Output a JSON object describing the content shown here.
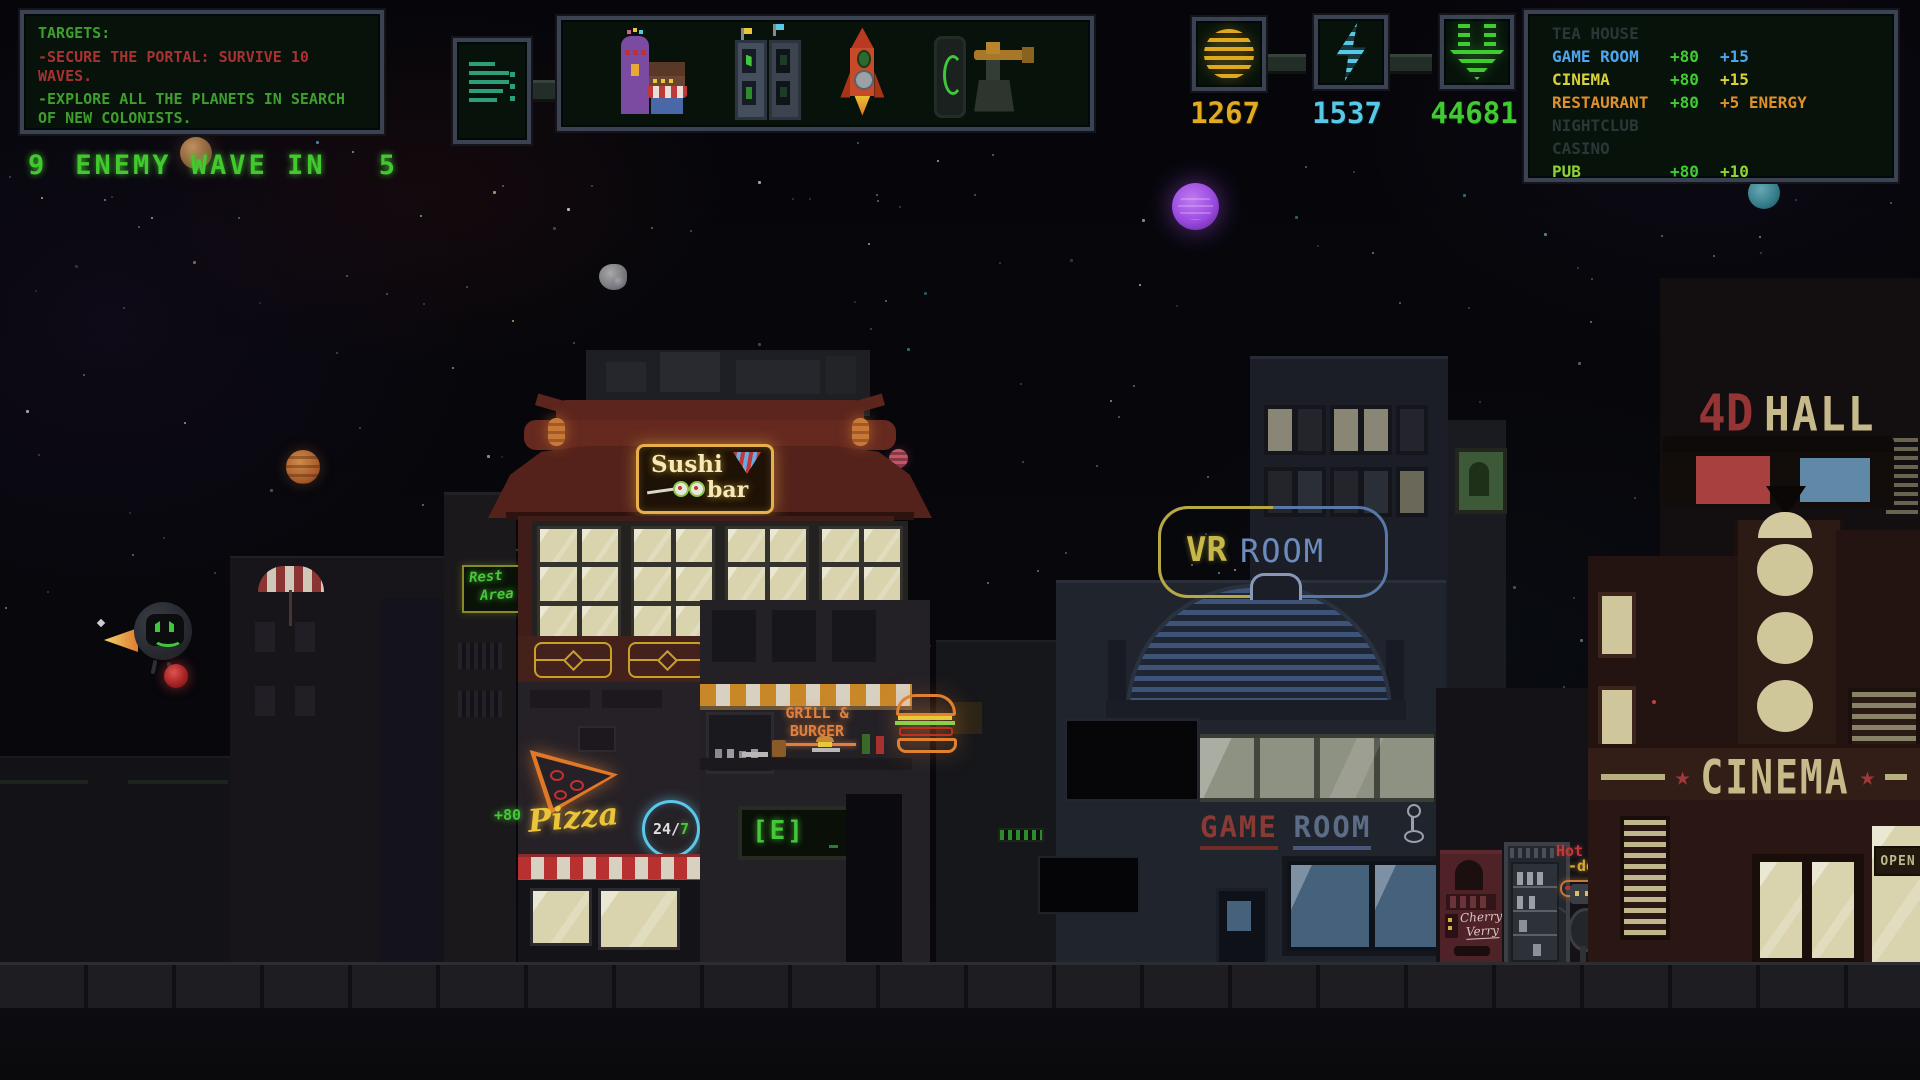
{
  "hud": {
    "targets": {
      "title": "TARGETS:",
      "objective1": "-SECURE THE PORTAL: SURVIVE 10 WAVES.",
      "objective2": "-EXPLORE ALL THE PLANETS IN SEARCH OF NEW COLONISTS.",
      "objective1_color": "#a83232",
      "objective2_color": "#3f9e2d"
    },
    "wave": {
      "count": "9",
      "label": "ENEMY WAVE IN",
      "timer": "5"
    },
    "resources": [
      {
        "id": "coins",
        "value": "1267",
        "color": "#e2aa1e",
        "icon": "coin-icon"
      },
      {
        "id": "energy",
        "value": "1537",
        "color": "#58c8e8",
        "icon": "lightning-icon"
      },
      {
        "id": "income",
        "value": "44681",
        "color": "#40cb32",
        "icon": "download-arrows-icon"
      }
    ],
    "toolbar_icons": [
      "menu-lines-icon",
      "shop-buildings-icon",
      "machines-icon",
      "rocket-icon",
      "phone-turret-icon"
    ],
    "build_menu": {
      "cost_color": "#40cb32",
      "rows": [
        {
          "label": "TEA HOUSE",
          "cost": "",
          "bonus": "",
          "color": "#2b3737",
          "enabled": false
        },
        {
          "label": "GAME ROOM",
          "cost": "+80",
          "bonus": "+15",
          "color": "#4da6f0",
          "enabled": true
        },
        {
          "label": "CINEMA",
          "cost": "+80",
          "bonus": "+15",
          "color": "#d8d23a",
          "enabled": true
        },
        {
          "label": "RESTAURANT",
          "cost": "+80",
          "bonus": "+5 ENERGY",
          "color": "#e0902a",
          "enabled": true
        },
        {
          "label": "NIGHTCLUB",
          "cost": "",
          "bonus": "",
          "color": "#2b3737",
          "enabled": false
        },
        {
          "label": "CASINO",
          "cost": "",
          "bonus": "",
          "color": "#2b3737",
          "enabled": false
        },
        {
          "label": "PUB",
          "cost": "+80",
          "bonus": "+10",
          "color": "#8fd435",
          "enabled": true
        }
      ]
    }
  },
  "scene": {
    "sushi_bar": {
      "line1": "Sushi",
      "line2": "bar"
    },
    "rest_area": {
      "line1": "Rest",
      "line2": "Area"
    },
    "pizza": {
      "name": "Pizza",
      "bonus": "+80",
      "badge_left": "24/",
      "badge_right": "7"
    },
    "grill": {
      "line1": "GRILL &",
      "line2": "BURGER"
    },
    "interact_prompt": "[E]",
    "vr_room": {
      "left": "VR",
      "right": "ROOM"
    },
    "game_room": {
      "left": "GAME",
      "right": "ROOM"
    },
    "hall_4d": {
      "prefix": "4D",
      "name": "HALL"
    },
    "cinema": {
      "name": "CINEMA",
      "star": "★"
    },
    "open_sign": "OPEN",
    "cherry_machine": {
      "line1": "Cherry",
      "line2": "Verry"
    },
    "hotdog": {
      "line1": "Hot",
      "line2": "-dog"
    }
  }
}
